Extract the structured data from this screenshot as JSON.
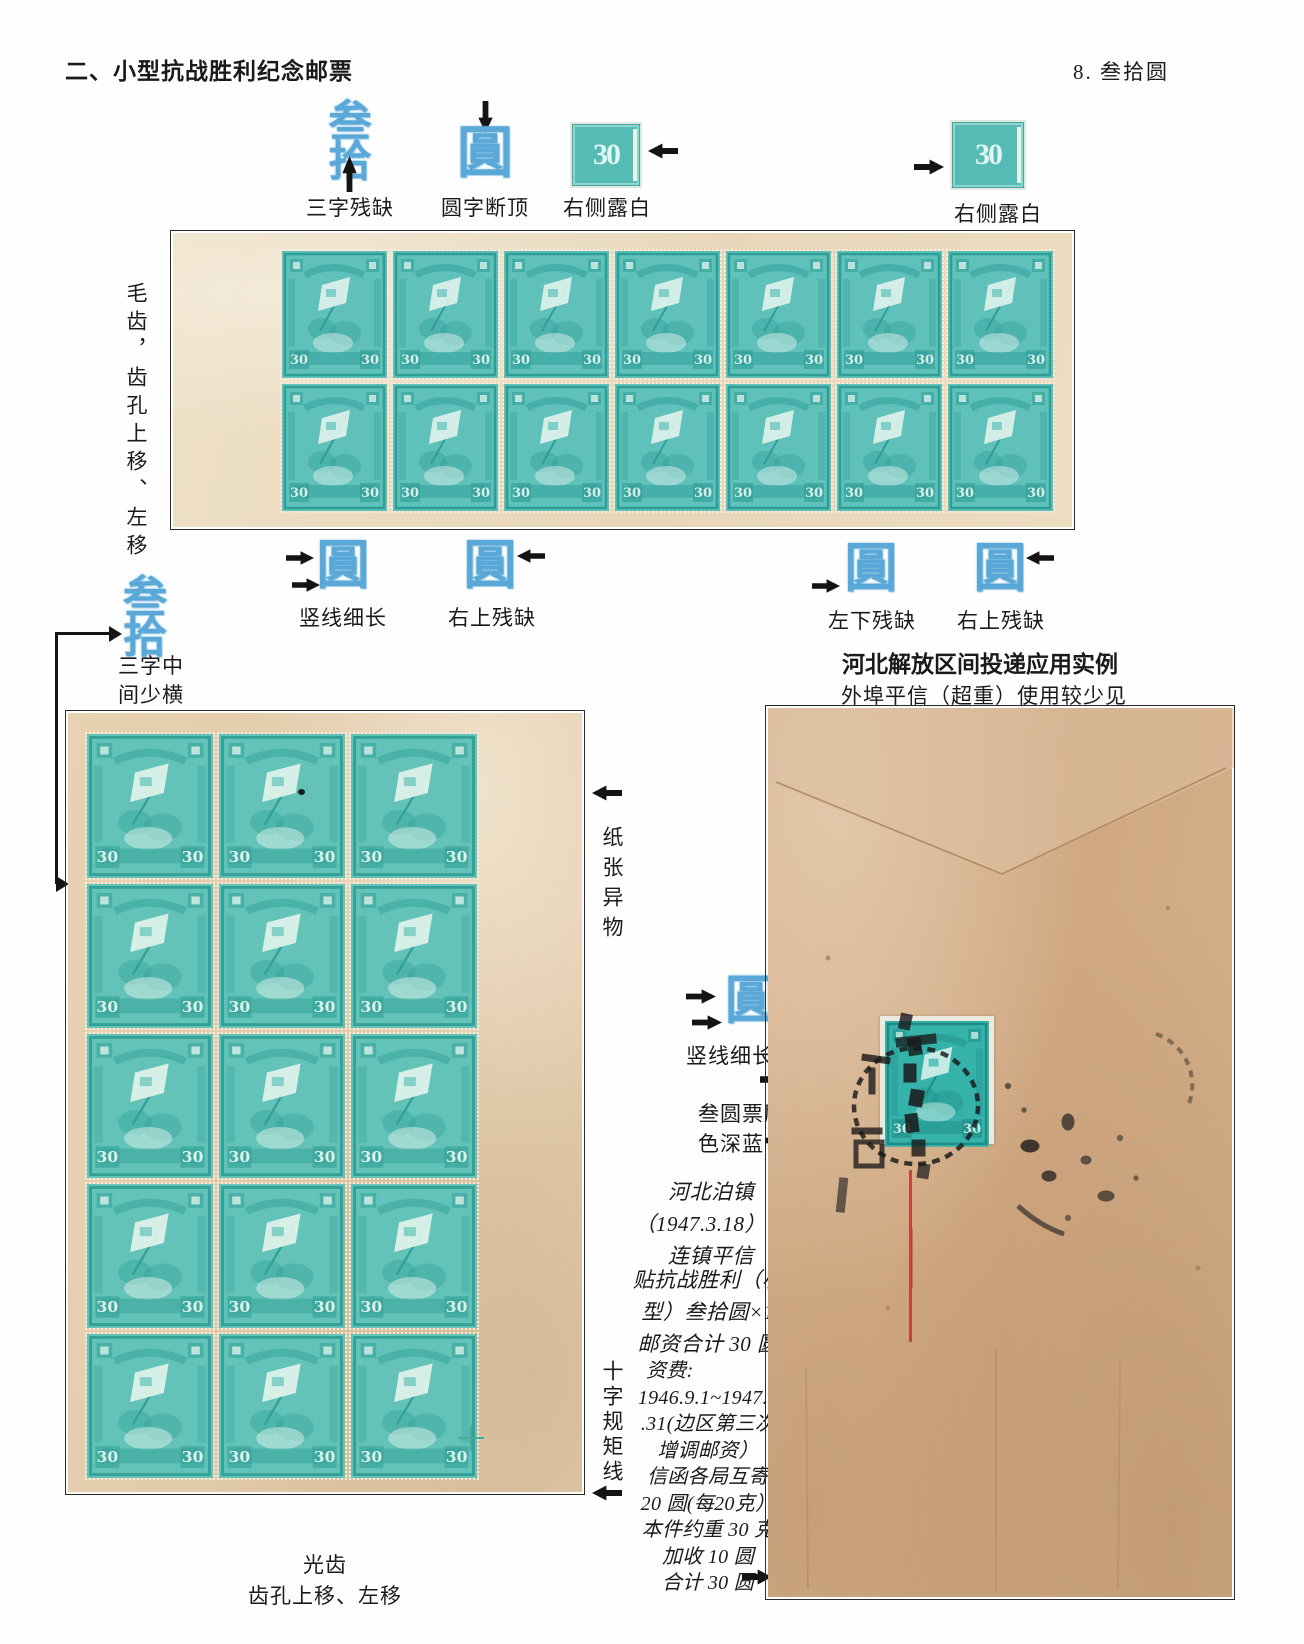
{
  "page": {
    "header_left": "二、小型抗战胜利纪念邮票",
    "header_right": "8. 叁拾圆"
  },
  "colors": {
    "stamp_base_top": "#5fc1ba",
    "stamp_dark_top": "#2f9e98",
    "stamp_pale_top": "#d9efe9",
    "stamp_base_bottom": "#63c3b9",
    "stamp_dark_bottom": "#33a198",
    "stamp_pale_bottom": "#dcf1e9",
    "stamp_base_cover": "#35b2aa",
    "stamp_dark_cover": "#1f8d86",
    "stamp_pale_cover": "#cdeee7",
    "callout_blue": "#5aa8d7",
    "red_line": "#c03434"
  },
  "glyphs": {
    "san": "叁",
    "shi": "拾",
    "yuan": "圓"
  },
  "stamp": {
    "value": "30"
  },
  "top_callouts": {
    "c1_caption": "三字残缺",
    "c2_caption": "圆字断顶",
    "c3_caption": "右侧露白",
    "c4_caption": "右侧露白"
  },
  "top_block": {
    "rows": 2,
    "cols": 7,
    "side_label": "毛齿，齿孔上移、左移"
  },
  "mid_callouts": {
    "c1_caption": "竖线细长",
    "c2_caption": "右上残缺",
    "c3_caption": "左下残缺",
    "c4_caption": "右上残缺"
  },
  "left_callout": {
    "caption_line1": "三字中",
    "caption_line2": "间少横"
  },
  "bottom_block": {
    "rows": 5,
    "cols": 3,
    "side_top": "纸张异物",
    "side_bottom": "十字规矩线",
    "caption_line1": "光齿",
    "caption_line2": "齿孔上移、左移"
  },
  "cover": {
    "title": "河北解放区间投递应用实例",
    "subtitle": "外埠平信（超重）使用较少见",
    "callout_caption": "竖线细长",
    "note_line1": "叁圆票刷",
    "note_line2": "色深蓝",
    "it1": [
      "河北泊镇",
      "（1947.3.18）寄",
      "连镇平信"
    ],
    "it2": [
      "贴抗战胜利（小",
      "型）叁拾圆×1",
      "邮资合计 30 圆"
    ],
    "it3": [
      "资费:",
      "1946.9.1~1947.3",
      ".31(边区第三次",
      "增调邮资）",
      "信函各局互寄",
      "20 圆(每20克）",
      "本件约重 30 克",
      "加收 10 圆",
      "合计 30 圆"
    ]
  }
}
